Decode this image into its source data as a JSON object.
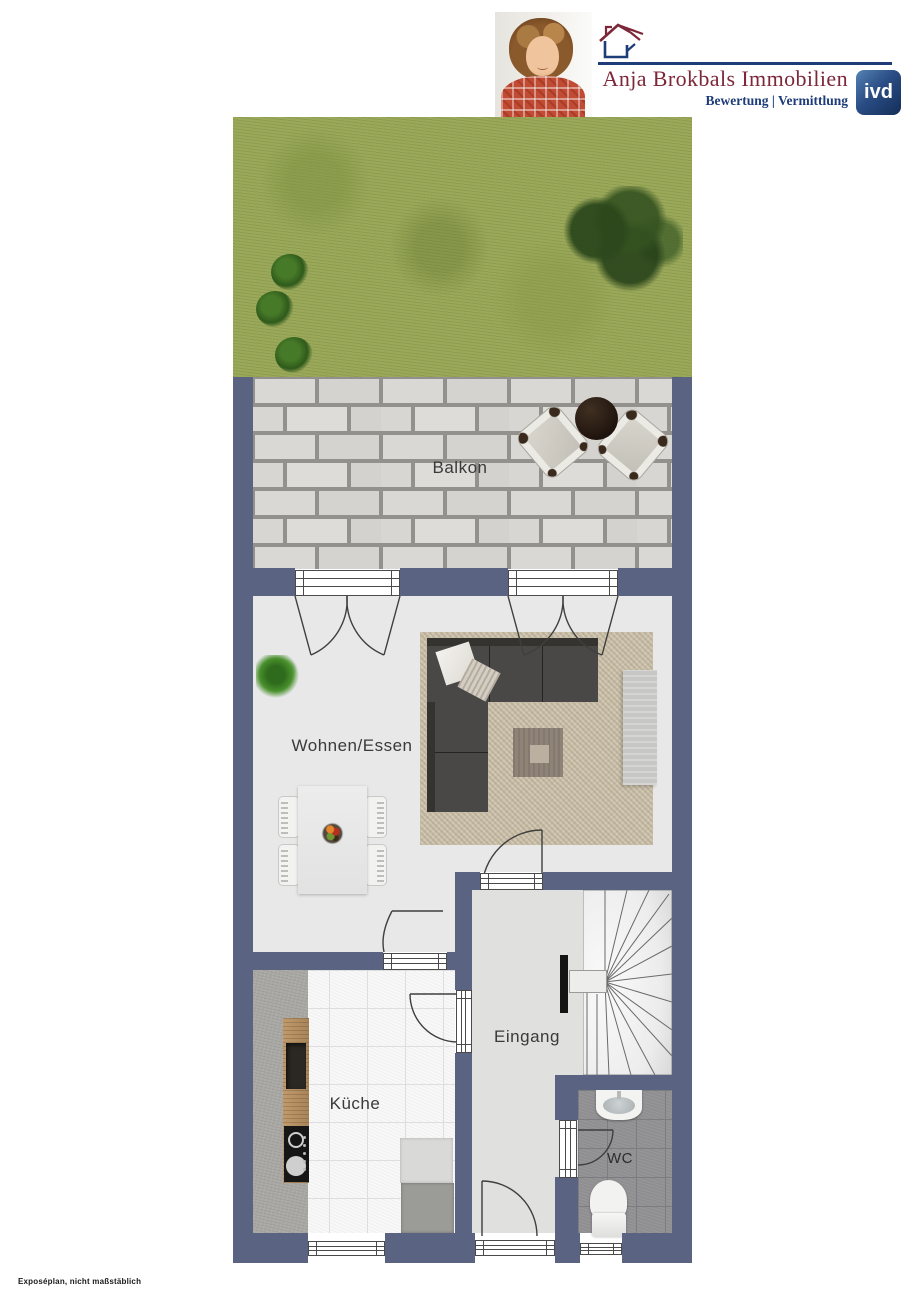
{
  "header": {
    "company": "Anja Brokbals Immobilien",
    "tagline": "Bewertung | Vermittlung",
    "ivd_label": "ivd"
  },
  "plan": {
    "labels": {
      "balkon": "Balkon",
      "wohnen": "Wohnen/Essen",
      "eingang": "Eingang",
      "kueche": "Küche",
      "wc": "WC"
    }
  },
  "footer": {
    "note": "Exposéplan, nicht maßstäblich"
  },
  "icons": {
    "logo": "house-icon",
    "badge": "ivd-association-badge"
  },
  "colors": {
    "wall": "#5a6482",
    "accentRed": "#7c2839",
    "accentBlue": "#1e3c78",
    "garden": "#9aa85a",
    "floorLight": "#e8e8e9",
    "floorEingang": "#e0e0df",
    "rug": "#cbc0aa",
    "sofa": "#4a4846",
    "wcTile": "#8f8f91",
    "tileWhite": "#f8f8f8"
  }
}
